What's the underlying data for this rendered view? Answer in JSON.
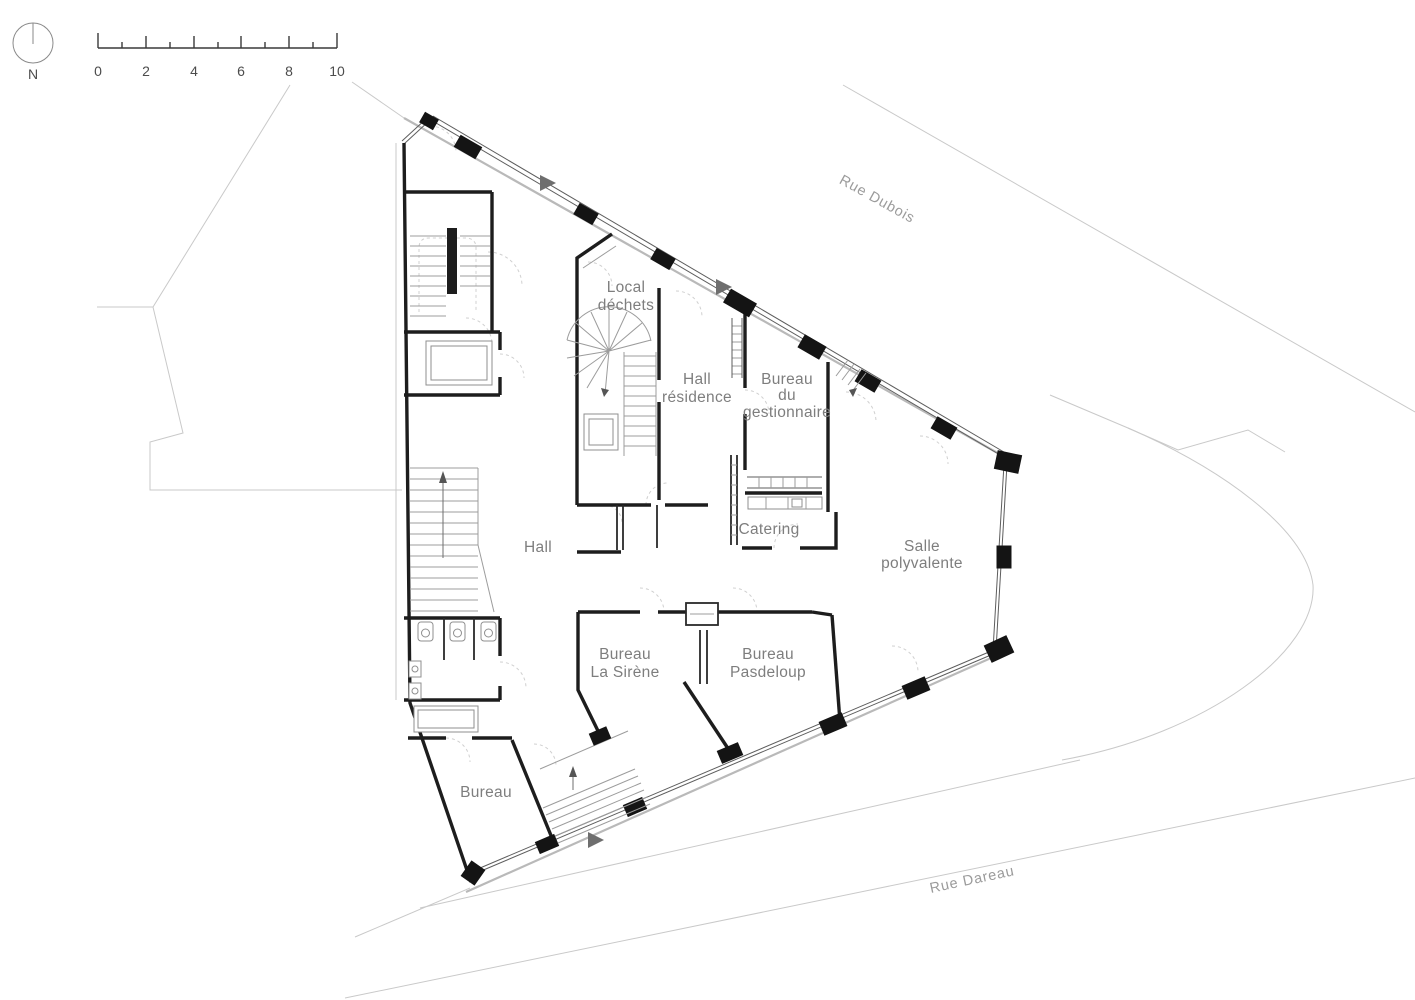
{
  "compass": {
    "label": "N"
  },
  "scale_bar": {
    "labels": [
      "0",
      "2",
      "4",
      "6",
      "8",
      "10"
    ]
  },
  "streets": {
    "dubois": "Rue Dubois",
    "dareau": "Rue Dareau"
  },
  "rooms": {
    "local_dechets": {
      "l1": "Local",
      "l2": "déchets"
    },
    "hall_residence": {
      "l1": "Hall",
      "l2": "résidence"
    },
    "bureau_gestionnaire": {
      "l1": "Bureau",
      "l2": "du",
      "l3": "gestionnaire"
    },
    "hall": {
      "l1": "Hall"
    },
    "catering": {
      "l1": "Catering"
    },
    "salle_polyvalente": {
      "l1": "Salle",
      "l2": "polyvalente"
    },
    "bureau_la_sirene": {
      "l1": "Bureau",
      "l2": "La Sirène"
    },
    "bureau_pasdeloup": {
      "l1": "Bureau",
      "l2": "Pasdeloup"
    },
    "bureau": {
      "l1": "Bureau"
    }
  },
  "colors": {
    "wall": "#1d1d1d",
    "room_label": "#7e7e7e",
    "street_label": "#9b9b9b",
    "context_line": "#c9c9c9",
    "entrance_arrow": "#6e6e6e",
    "detail": "#9c9c9c"
  }
}
